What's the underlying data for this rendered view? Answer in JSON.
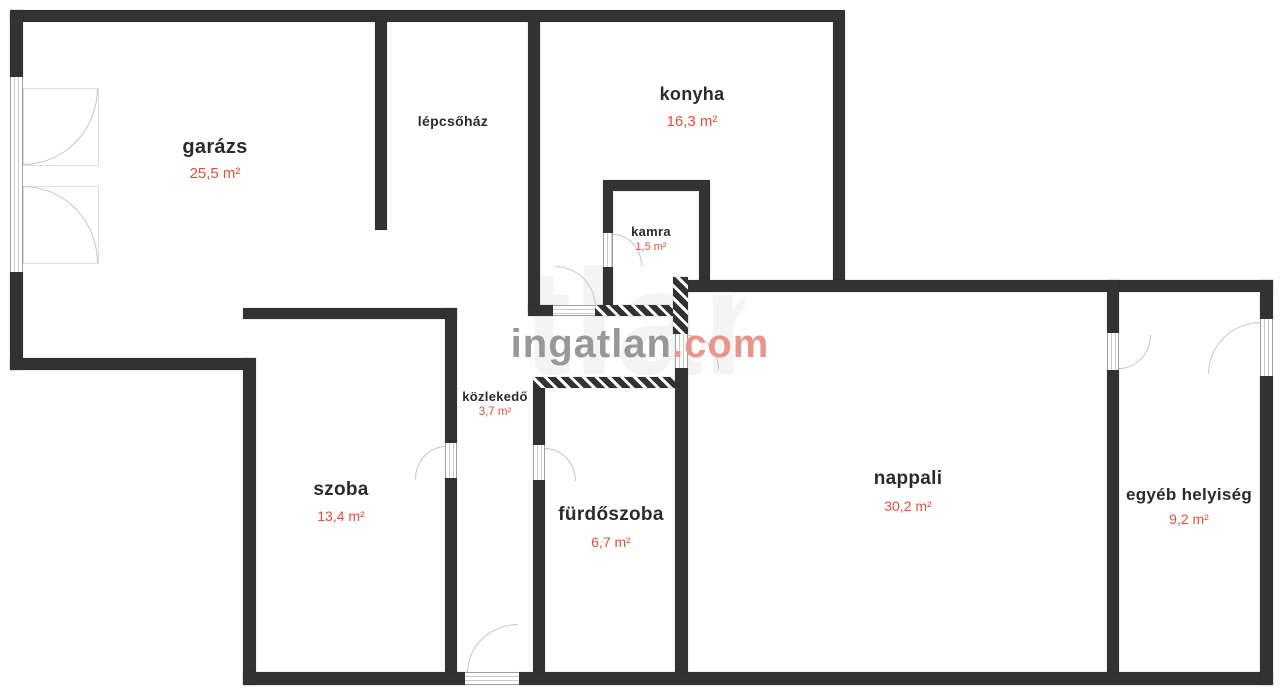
{
  "plan": {
    "watermark": {
      "brand": "ingatlan",
      "tld": ".com"
    },
    "rooms": [
      {
        "id": "garazs",
        "name": "garázs",
        "area": "25,5 m²"
      },
      {
        "id": "lepcsohaz",
        "name": "lépcsőház",
        "area": ""
      },
      {
        "id": "konyha",
        "name": "konyha",
        "area": "16,3 m²"
      },
      {
        "id": "kamra",
        "name": "kamra",
        "area": "1,5 m²"
      },
      {
        "id": "kozlekedo",
        "name": "közlekedő",
        "area": "3,7 m²"
      },
      {
        "id": "szoba",
        "name": "szoba",
        "area": "13,4 m²"
      },
      {
        "id": "furdoszoba",
        "name": "fürdőszoba",
        "area": "6,7 m²"
      },
      {
        "id": "nappali",
        "name": "nappali",
        "area": "30,2 m²"
      },
      {
        "id": "egyeb_helyiseg",
        "name": "egyéb helyiség",
        "area": "9,2 m²"
      }
    ],
    "colors": {
      "wall": "#333233",
      "room_text": "#2b2b2b",
      "area_text": "#e0513c",
      "wm_gray": "#97989a",
      "wm_accent": "#e9958a"
    }
  }
}
